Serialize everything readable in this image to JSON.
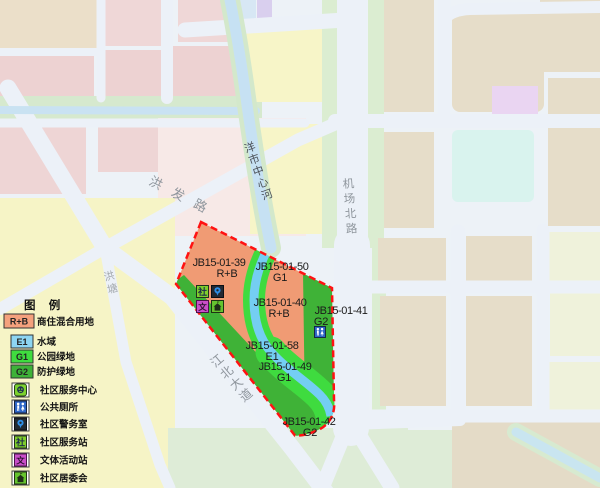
{
  "map": {
    "road_labels": {
      "hongfa": "洪发路",
      "hongtang": "洪塘",
      "jiangbei": "江北大道",
      "jichangbei": "机场北路"
    },
    "river_label": "洋市中心河",
    "parcels": {
      "p39": {
        "id": "JB15-01-39",
        "use": "R+B"
      },
      "p50": {
        "id": "JB15-01-50",
        "use": "G1"
      },
      "p40": {
        "id": "JB15-01-40",
        "use": "R+B"
      },
      "p41": {
        "id": "JB15-01-41",
        "use": "G2"
      },
      "p58": {
        "id": "JB15-01-58",
        "use": "E1"
      },
      "p49": {
        "id": "JB15-01-49",
        "use": "G1"
      },
      "p42": {
        "id": "JB15-01-42",
        "use": "G2"
      }
    }
  },
  "legend": {
    "title": "图 例",
    "zones": [
      {
        "code": "R+B",
        "label": "商住混合用地",
        "color": "#F4A17D"
      },
      {
        "code": "E1",
        "label": "水域",
        "color": "#8DD5F2"
      },
      {
        "code": "G1",
        "label": "公园绿地",
        "color": "#3FDC3F"
      },
      {
        "code": "G2",
        "label": "防护绿地",
        "color": "#3EB238"
      }
    ],
    "facilities": [
      {
        "icon": "community-service-center-icon",
        "label": "社区服务中心"
      },
      {
        "icon": "public-toilet-icon",
        "label": "公共厕所"
      },
      {
        "icon": "community-police-room-icon",
        "label": "社区警务室"
      },
      {
        "icon": "community-service-station-icon",
        "label": "社区服务站"
      },
      {
        "icon": "culture-sports-station-icon",
        "label": "文体活动站"
      },
      {
        "icon": "residents-committee-icon",
        "label": "社区居委会"
      }
    ]
  },
  "colors": {
    "boundary_red": "#FF1212",
    "rb_fill": "#F09B74",
    "g1_fill": "#3FDB3F",
    "g2_fill": "#3FB237",
    "water_fill": "#74CEF2",
    "road_fill": "#ECF1F8"
  }
}
